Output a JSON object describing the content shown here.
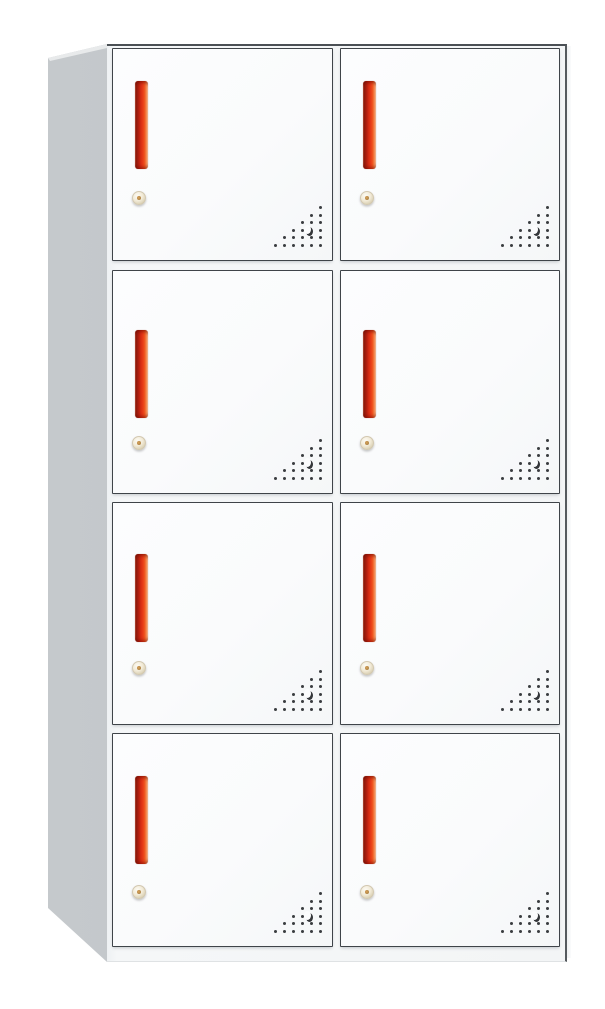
{
  "product": {
    "name": "8-door metal locker cabinet",
    "door_count": 8,
    "rows": 4,
    "columns": 2
  },
  "door": {
    "handle": {
      "name": "recessed-vertical-handle",
      "color_dark": "#8f1a0d",
      "color_bright": "#e83d18",
      "color_glow": "#f59a62"
    },
    "lock": {
      "name": "cam-lock-keyhole",
      "body_color": "#f2ebd8",
      "pin_color": "#b98a50"
    },
    "vent": {
      "name": "triangular-vent-holes",
      "rows_bottom_to_top": [
        6,
        5,
        4,
        3,
        2,
        1
      ],
      "dot_color": "#3a3d40",
      "crescent_hole": true,
      "crescent_row_from_top": 3,
      "crescent_col_from_right": 1
    }
  },
  "colors": {
    "background": "#ffffff",
    "door_face": "#fbfcfd",
    "front_frame": "#f3f5f6",
    "door_border": "#3f4449",
    "side_panel": "#c2c6c9",
    "front_top_edge": "#4b5055"
  }
}
